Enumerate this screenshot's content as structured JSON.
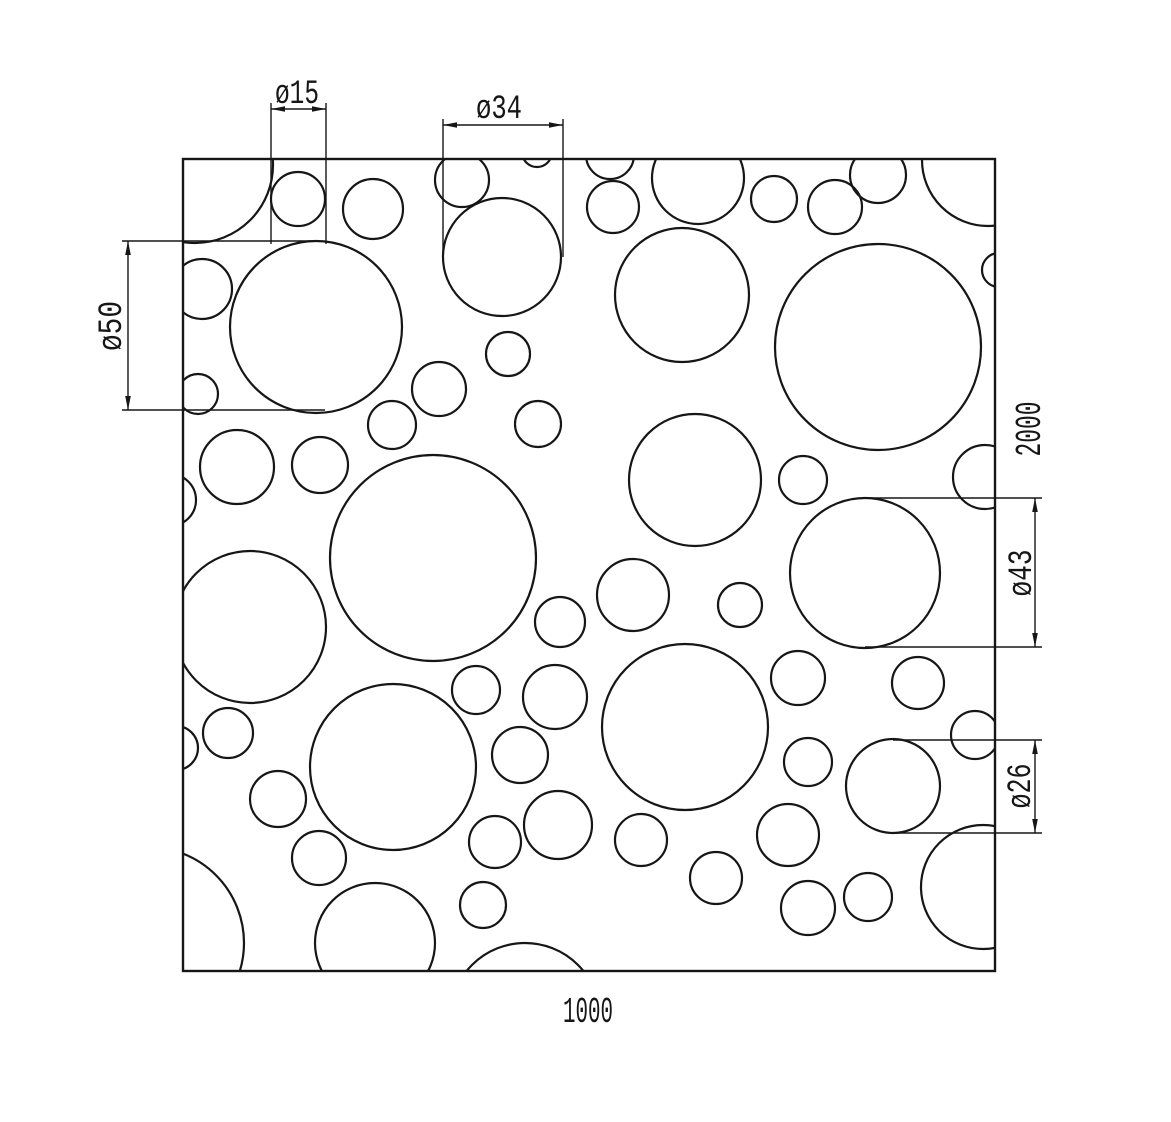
{
  "drawing": {
    "background": "#ffffff",
    "line_color": "#161616",
    "panel": {
      "x": 183,
      "y": 159,
      "width": 812,
      "height": 812,
      "width_label": "1000",
      "height_label": "2000"
    },
    "hole_callouts": [
      "ø15",
      "ø34",
      "ø50",
      "ø43",
      "ø26"
    ],
    "circles": [
      [
        195,
        165,
        78
      ],
      [
        298,
        199,
        27
      ],
      [
        373,
        209,
        30
      ],
      [
        462,
        180,
        27
      ],
      [
        502,
        257,
        59
      ],
      [
        537,
        152,
        15
      ],
      [
        610,
        155,
        24
      ],
      [
        613,
        207,
        26
      ],
      [
        698,
        178,
        46
      ],
      [
        774,
        199,
        23
      ],
      [
        835,
        207,
        27
      ],
      [
        878,
        175,
        28
      ],
      [
        988,
        160,
        66
      ],
      [
        999,
        270,
        17
      ],
      [
        682,
        295,
        67
      ],
      [
        878,
        347,
        103
      ],
      [
        202,
        289,
        30
      ],
      [
        316,
        327,
        86
      ],
      [
        198,
        394,
        20
      ],
      [
        237,
        467,
        37
      ],
      [
        320,
        465,
        28
      ],
      [
        392,
        425,
        24
      ],
      [
        439,
        389,
        27
      ],
      [
        508,
        354,
        22
      ],
      [
        538,
        424,
        23
      ],
      [
        433,
        558,
        103
      ],
      [
        170,
        500,
        26
      ],
      [
        250,
        627,
        76
      ],
      [
        560,
        622,
        25
      ],
      [
        633,
        595,
        36
      ],
      [
        695,
        480,
        66
      ],
      [
        803,
        480,
        24
      ],
      [
        985,
        477,
        32
      ],
      [
        865,
        573,
        75
      ],
      [
        740,
        605,
        22
      ],
      [
        148,
        943,
        96
      ],
      [
        176,
        748,
        22
      ],
      [
        228,
        733,
        25
      ],
      [
        278,
        799,
        28
      ],
      [
        319,
        858,
        27
      ],
      [
        393,
        767,
        83
      ],
      [
        375,
        943,
        60
      ],
      [
        476,
        690,
        24
      ],
      [
        555,
        697,
        32
      ],
      [
        520,
        755,
        28
      ],
      [
        495,
        842,
        26
      ],
      [
        483,
        905,
        23
      ],
      [
        525,
        1018,
        75
      ],
      [
        558,
        825,
        34
      ],
      [
        641,
        840,
        26
      ],
      [
        685,
        727,
        83
      ],
      [
        716,
        878,
        26
      ],
      [
        788,
        835,
        31
      ],
      [
        808,
        762,
        24
      ],
      [
        808,
        908,
        27
      ],
      [
        868,
        897,
        24
      ],
      [
        893,
        786,
        47
      ],
      [
        918,
        683,
        26
      ],
      [
        975,
        735,
        24
      ],
      [
        983,
        887,
        62
      ],
      [
        798,
        678,
        27
      ]
    ],
    "dimensions": [
      {
        "id": "dia-15",
        "label": "ø15",
        "ext_lines": [
          [
            271,
            103,
            271,
            244
          ],
          [
            326,
            103,
            326,
            244
          ]
        ],
        "dim_line": [
          271,
          109,
          326,
          109
        ],
        "arrows": [
          [
            271,
            109,
            "left"
          ],
          [
            326,
            109,
            "right"
          ]
        ],
        "text": {
          "x": 297,
          "y": 103,
          "rotate": 0,
          "font_size": 34,
          "length": 44
        }
      },
      {
        "id": "dia-34",
        "label": "ø34",
        "ext_lines": [
          [
            443,
            119,
            443,
            257
          ],
          [
            563,
            119,
            563,
            257
          ]
        ],
        "dim_line": [
          443,
          125,
          563,
          125
        ],
        "arrows": [
          [
            443,
            125,
            "left"
          ],
          [
            563,
            125,
            "right"
          ]
        ],
        "text": {
          "x": 499,
          "y": 118,
          "rotate": 0,
          "font_size": 34,
          "length": 46
        }
      },
      {
        "id": "dia-50",
        "label": "ø50",
        "ext_lines": [
          [
            122,
            241,
            316,
            241
          ],
          [
            122,
            410,
            325,
            410
          ]
        ],
        "dim_line": [
          128,
          241,
          128,
          410
        ],
        "arrows": [
          [
            128,
            241,
            "up"
          ],
          [
            128,
            410,
            "down"
          ]
        ],
        "text": {
          "x": 121,
          "y": 326,
          "rotate": -90,
          "font_size": 34,
          "length": 50
        }
      },
      {
        "id": "dia-43",
        "label": "ø43",
        "ext_lines": [
          [
            865,
            498,
            1042,
            498
          ],
          [
            865,
            647,
            1042,
            647
          ]
        ],
        "dim_line": [
          1035,
          498,
          1035,
          647
        ],
        "arrows": [
          [
            1035,
            498,
            "up"
          ],
          [
            1035,
            647,
            "down"
          ]
        ],
        "text": {
          "x": 1031,
          "y": 573,
          "rotate": -90,
          "font_size": 34,
          "length": 47
        }
      },
      {
        "id": "dia-26",
        "label": "ø26",
        "ext_lines": [
          [
            893,
            740,
            1042,
            740
          ],
          [
            893,
            833,
            1042,
            833
          ]
        ],
        "dim_line": [
          1035,
          740,
          1035,
          833
        ],
        "arrows": [
          [
            1035,
            740,
            "up"
          ],
          [
            1035,
            833,
            "down"
          ]
        ],
        "text": {
          "x": 1030,
          "y": 786,
          "rotate": -90,
          "font_size": 34,
          "length": 45
        }
      }
    ],
    "labels": [
      {
        "id": "width-label",
        "text": "1000",
        "x": 588,
        "y": 1022,
        "rotate": 0,
        "font_size": 36,
        "length": 50
      },
      {
        "id": "height-label",
        "text": "2000",
        "x": 1040,
        "y": 429,
        "rotate": -90,
        "font_size": 36,
        "length": 55
      }
    ]
  }
}
